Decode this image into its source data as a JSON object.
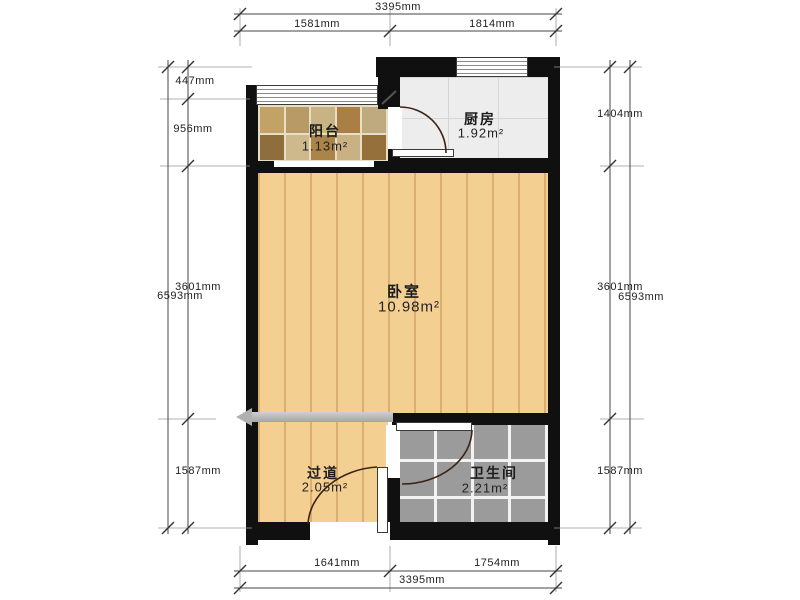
{
  "plan": {
    "type": "apartment-floor-plan",
    "rooms": {
      "balcony": {
        "name": "阳台",
        "area": "1.13m²"
      },
      "kitchen": {
        "name": "厨房",
        "area": "1.92m²"
      },
      "bedroom": {
        "name": "卧室",
        "area": "10.98m²"
      },
      "hallway": {
        "name": "过道",
        "area": "2.05m²"
      },
      "bathroom": {
        "name": "卫生间",
        "area": "2.21m²"
      }
    },
    "dimensions": {
      "top": {
        "overall": "3395mm",
        "segments": [
          "1581mm",
          "1814mm"
        ]
      },
      "bottom": {
        "overall": "3395mm",
        "segments": [
          "1641mm",
          "1754mm"
        ]
      },
      "left": {
        "overall": "6593mm",
        "segments": [
          "447mm",
          "956mm",
          "3601mm",
          "1587mm"
        ]
      },
      "right": {
        "overall": "6593mm",
        "segments": [
          "1404mm",
          "3601mm",
          "1587mm"
        ]
      }
    },
    "colors": {
      "wall": "#101010",
      "wood_floor": "#f3cf92",
      "wood_plank_line": "#d9ae6e",
      "kitchen_floor": "#ededed",
      "bathroom_tile": "#9b9b9b",
      "sliding_band": "#b0b0b0",
      "door_arc": "#3d2314",
      "dimension_line": "#444444",
      "balcony_tiles": [
        "#c3a268",
        "#b89a66",
        "#c8b384",
        "#a97f45",
        "#bfa97e",
        "#8f6e3e",
        "#cdb98c",
        "#ab8449",
        "#c9b183",
        "#96703a"
      ]
    }
  }
}
